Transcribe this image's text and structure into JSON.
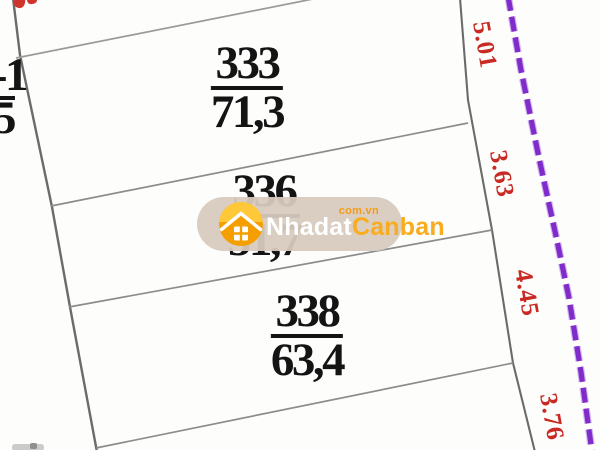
{
  "map": {
    "plots": [
      {
        "number": "333",
        "area": "71,3"
      },
      {
        "number": "336",
        "area": "51,7"
      },
      {
        "number": "338",
        "area": "63,4"
      }
    ],
    "edge_dimensions": [
      "5.01",
      "3.63",
      "4.45",
      "3.76"
    ],
    "neighbor_plot_partial": {
      "numerator_fragment": "-1",
      "denominator_fragment": "5"
    }
  },
  "watermark": {
    "brand_primary": "Nhadat",
    "brand_secondary": "Canban",
    "domain": "com.vn"
  },
  "colors": {
    "dimension_text_red": "#c92a23",
    "boundary_line_gray": "#6b6b6b",
    "divider_line_gray": "#8c8c8c",
    "planning_line_purple": "#7f2ccb",
    "plot_text_black": "#141414",
    "watermark_pill_beige": "#d8cbbf",
    "watermark_text_orange": "#f8ac1e",
    "logo_circle_orange": "#f59e00",
    "logo_roof_yellow": "#ffc839"
  }
}
